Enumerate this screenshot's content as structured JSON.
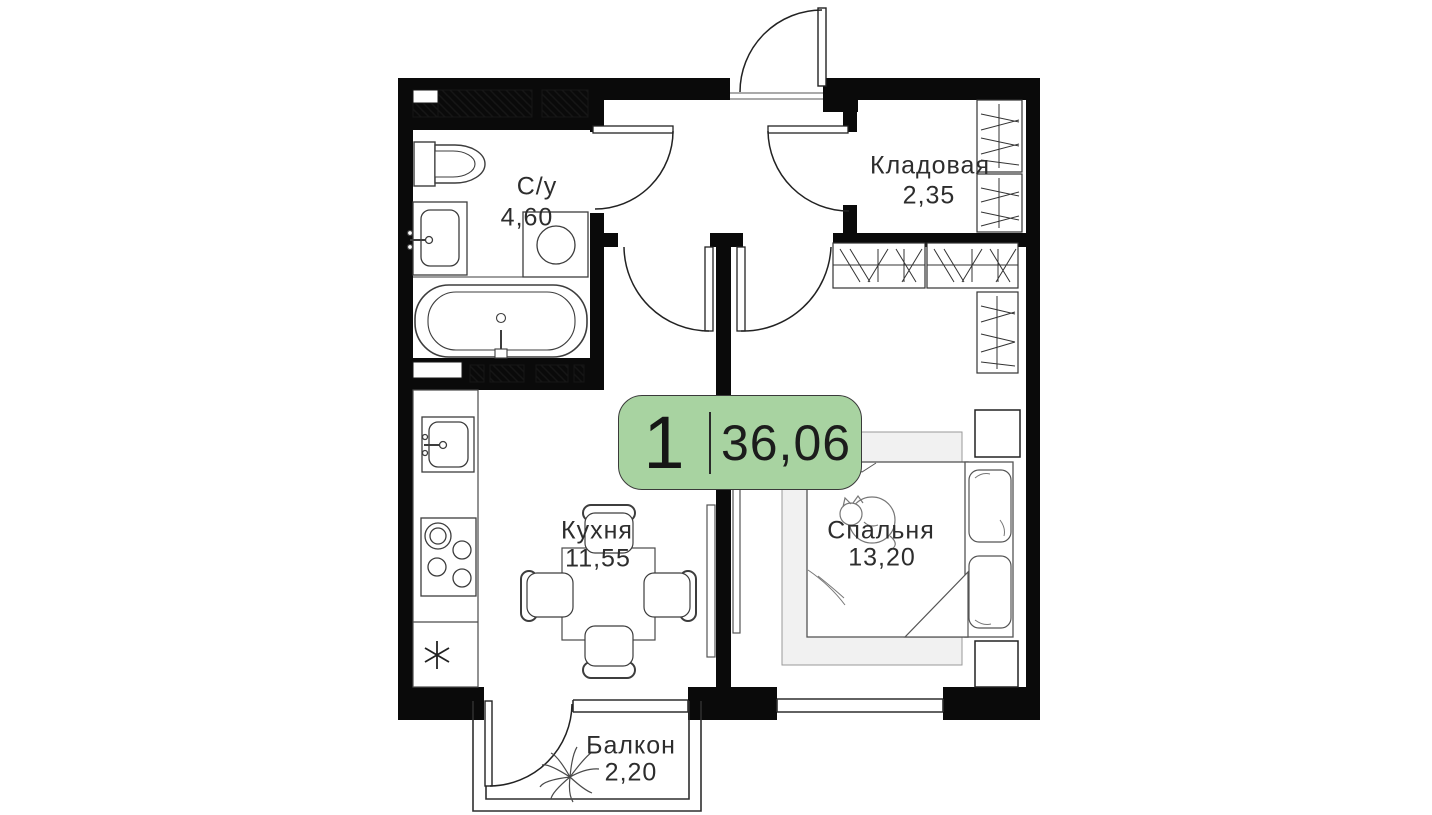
{
  "badge": {
    "rooms_count": "1",
    "total_area": "36,06",
    "bg_color": "#a8d3a1"
  },
  "rooms": {
    "bathroom": {
      "label": "С/у",
      "area": "4,60"
    },
    "storage": {
      "label": "Кладовая",
      "area": "2,35"
    },
    "kitchen": {
      "label": "Кухня",
      "area": "11,55"
    },
    "bedroom": {
      "label": "Спальня",
      "area": "13,20"
    },
    "balcony": {
      "label": "Балкон",
      "area": "2,20"
    }
  },
  "colors": {
    "wall": "#0a0a0a",
    "furniture_outline": "#3d3d3d",
    "rug_fill": "#f1f1f1",
    "badge_green": "#a8d3a1",
    "text": "#2d2d2d"
  },
  "icons": {
    "fridge": "snowflake-icon",
    "balcony_plant": "plant-icon",
    "bed_cat": "cat-icon"
  }
}
